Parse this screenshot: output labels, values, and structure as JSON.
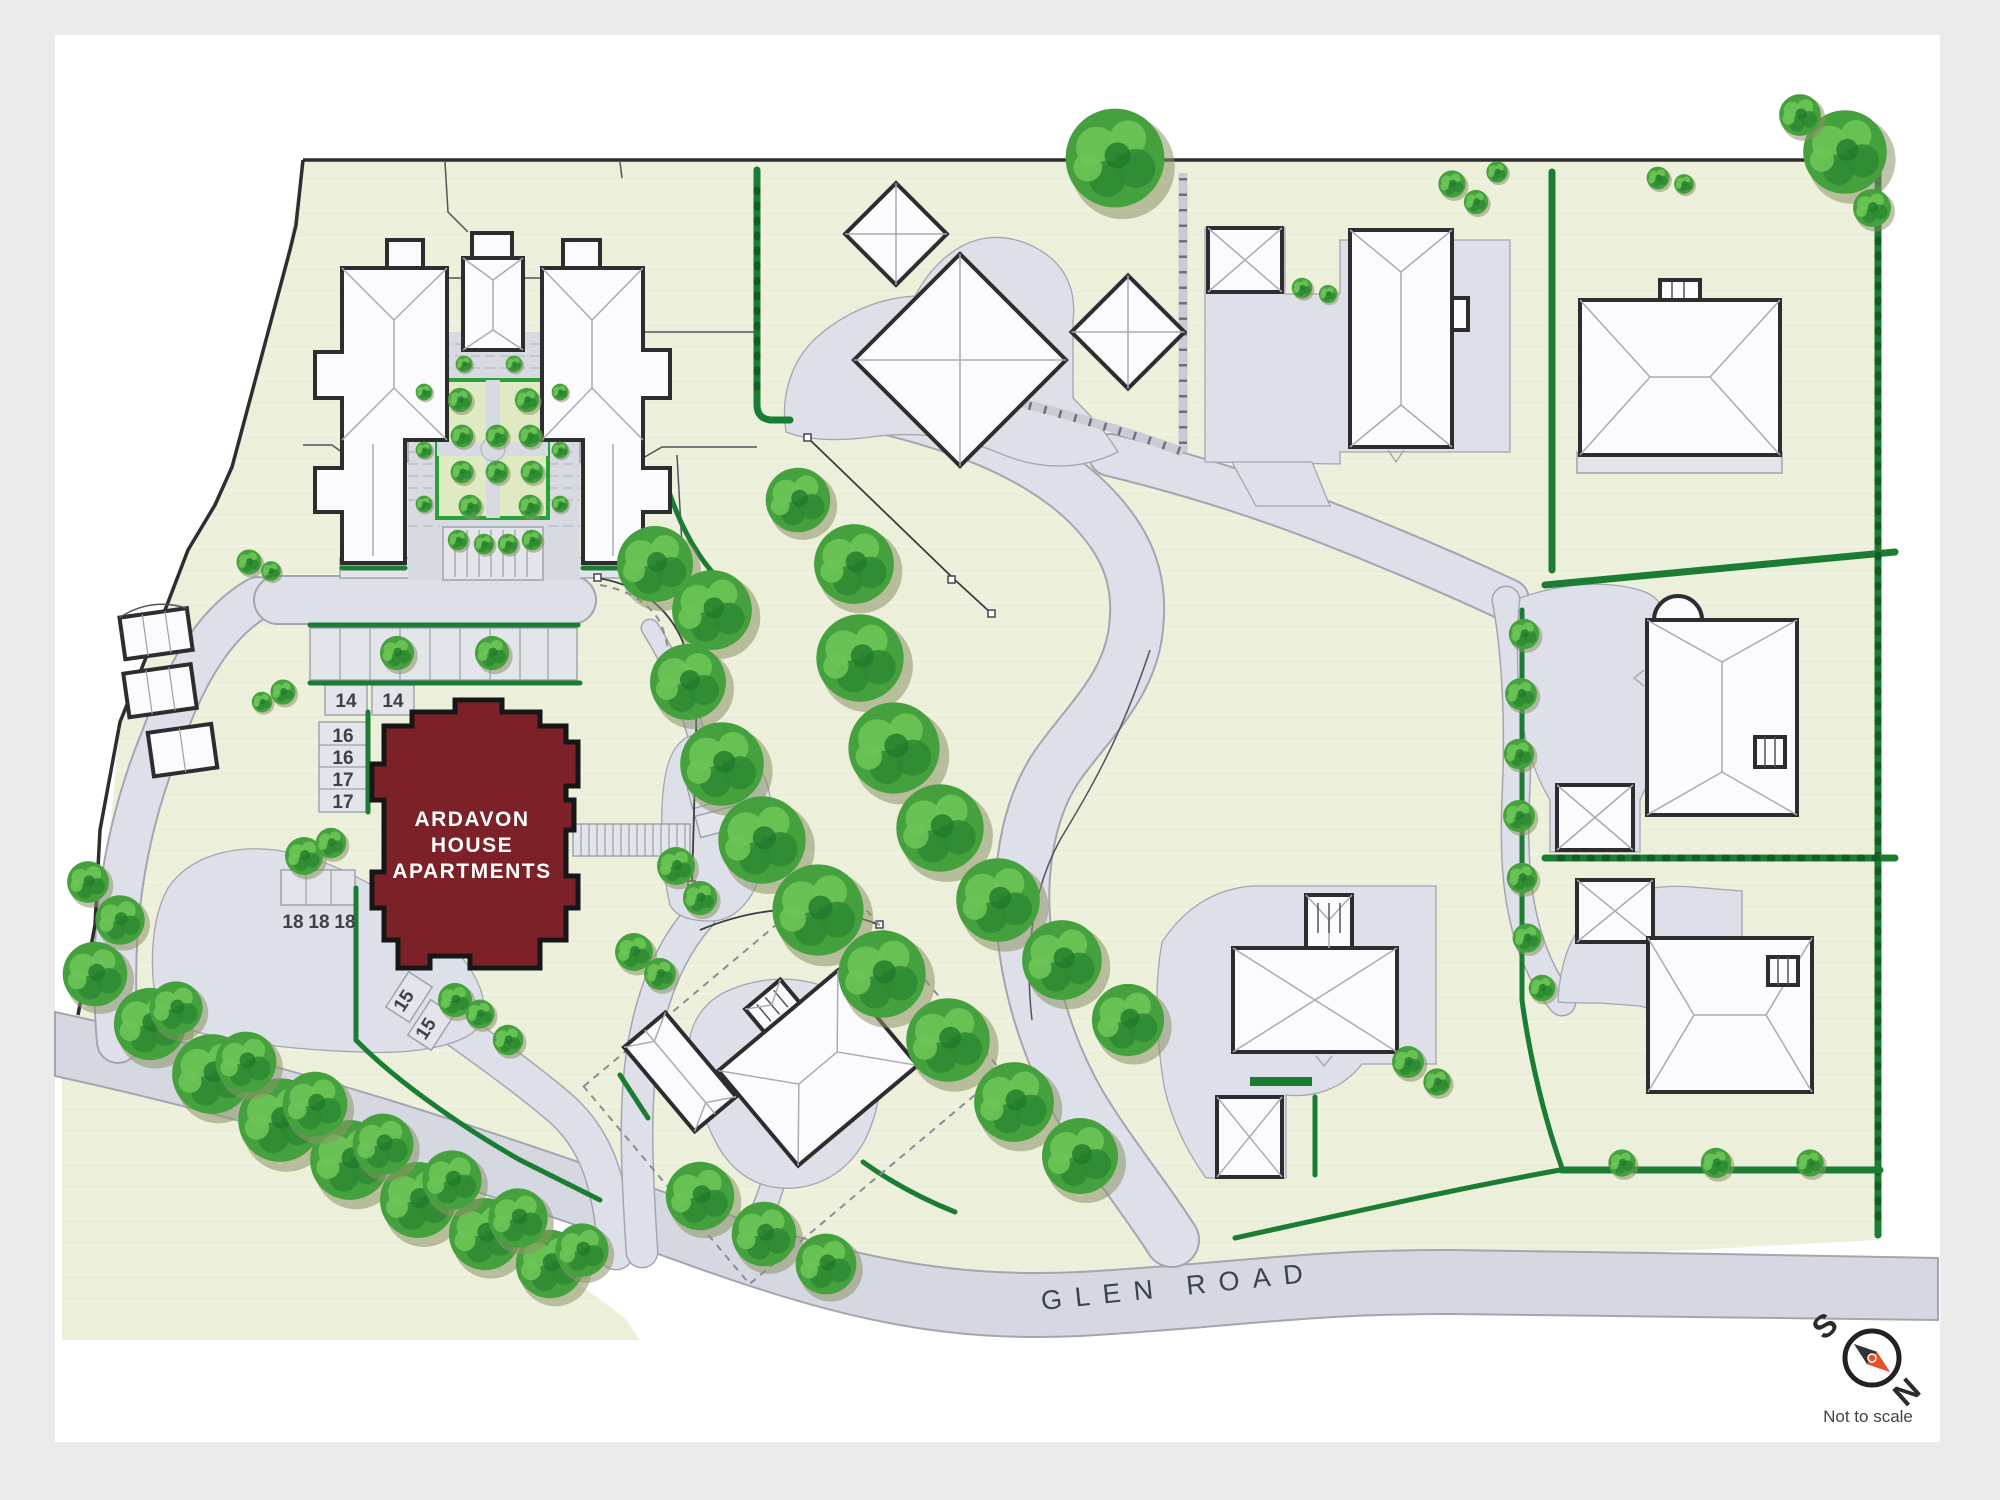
{
  "colors": {
    "page-bg": "#ebebec",
    "card-bg": "#ffffff",
    "site-green": "#ecf0da",
    "road-gray": "#d6d8e1",
    "drive-gray": "#dde0e8",
    "stall-gray": "#e3e5eb",
    "road-edge": "#a4a5b1",
    "brick-gray": "#d8dae2",
    "brick-line": "#b7bac4",
    "building-white": "#fbfbfd",
    "building-outline": "#2d2d30",
    "roofline": "#a9aab4",
    "apartments-red": "#7c2127",
    "apartments-outline": "#161616",
    "hedge-green": "#1b7c33",
    "hedge-bright": "#2aa23c",
    "garden-green": "#dfeac2",
    "tree-base": "#45a13d",
    "tree-light": "#6cc455",
    "tree-dark": "#2e8a31",
    "tree-deep": "#1f7a2b",
    "tree-shadow": "#8d9467",
    "wall-gray": "#c9ccd4",
    "wall-tick": "#70707a",
    "fence-dark": "#3b3b41",
    "boundary-dark": "#2e2e31",
    "text-dark": "#3e4246",
    "compass-orange": "#e8502a",
    "label-white": "#ffffff"
  },
  "main_building": {
    "label_lines": [
      "ARDAVON",
      "HOUSE",
      "APARTMENTS"
    ]
  },
  "roads": {
    "glen_road_label": "GLEN ROAD"
  },
  "compass": {
    "south_label": "S",
    "north_label": "N",
    "note": "Not to scale"
  },
  "parking_stalls": [
    {
      "label": "14"
    },
    {
      "label": "14"
    },
    {
      "label": "16"
    },
    {
      "label": "16"
    },
    {
      "label": "17"
    },
    {
      "label": "17"
    },
    {
      "label": "18"
    },
    {
      "label": "18"
    },
    {
      "label": "18"
    },
    {
      "label": "15"
    },
    {
      "label": "15"
    }
  ],
  "arrow_stalls": [
    {
      "label": ">"
    },
    {
      "label": ">"
    }
  ]
}
